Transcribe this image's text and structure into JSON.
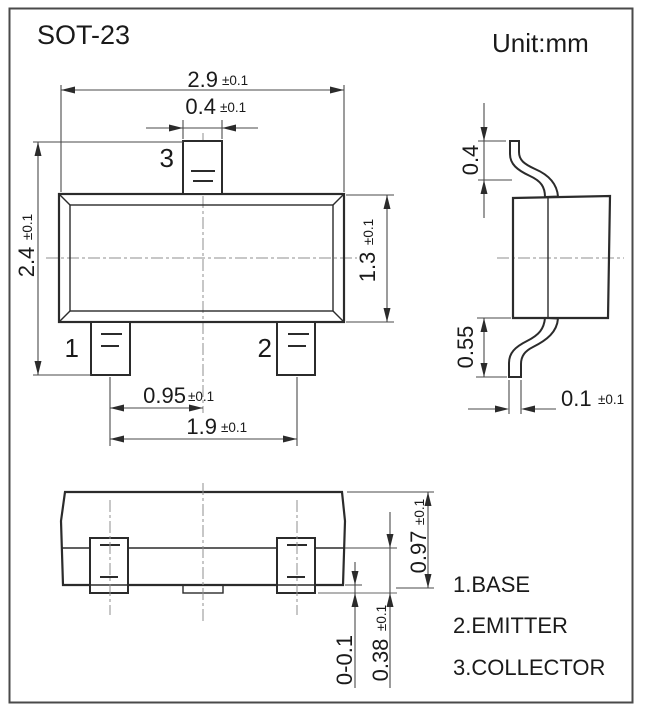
{
  "title": "SOT-23",
  "unit": "Unit:mm",
  "dims": {
    "body_length": {
      "v": "2.9",
      "t": "±0.1"
    },
    "lead_width": {
      "v": "0.4",
      "t": "±0.1"
    },
    "overall_width": {
      "v": "2.4",
      "t": "±0.1"
    },
    "body_width": {
      "v": "1.3",
      "t": "±0.1"
    },
    "lead_pitch": {
      "v": "0.95",
      "t": "±0.1"
    },
    "lead_span": {
      "v": "1.9",
      "t": "±0.1"
    },
    "lead_tip": {
      "v": "0.4"
    },
    "lead_foot": {
      "v": "0.55"
    },
    "lead_thickness": {
      "v": "0.1",
      "t": "±0.1"
    },
    "body_height": {
      "v": "0.97",
      "t": "±0.1"
    },
    "front_lead_height": {
      "v": "0.38",
      "t": "±0.1"
    },
    "standoff": {
      "v": "0-0.1"
    }
  },
  "pins": {
    "p1": "1",
    "p2": "2",
    "p3": "3"
  },
  "legend": [
    "1.BASE",
    "2.EMITTER",
    "3.COLLECTOR"
  ],
  "colors": {
    "line": "#2b2b2b",
    "dim": "#4a4a4a",
    "text": "#1a1a1a",
    "centerline": "#8f8f8f",
    "background": "#ffffff"
  }
}
